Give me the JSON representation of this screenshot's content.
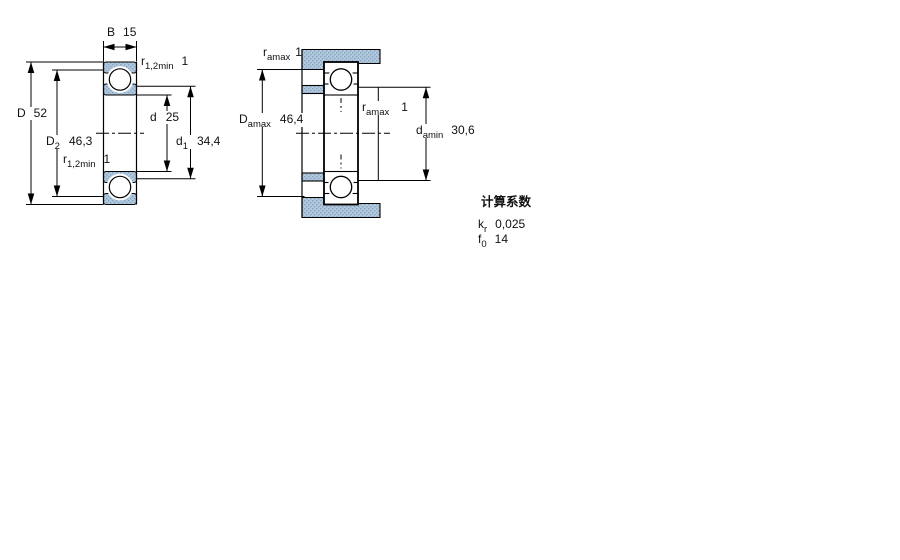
{
  "figure": {
    "type": "bearing-dimension-drawing",
    "background": "#ffffff",
    "line_color": "#000000",
    "hatch_base_color": "#b0c7dc",
    "hatch_dot_color": "#86a5c2"
  },
  "left_diagram": {
    "description": "bearing cross section with boundary dimensions",
    "labels": {
      "B": {
        "base": "B",
        "sub": "",
        "value": "15"
      },
      "D": {
        "base": "D",
        "sub": "",
        "value": "52"
      },
      "D2": {
        "base": "D",
        "sub": "2",
        "value": "46,3"
      },
      "r12_top": {
        "base": "r",
        "sub": "1,2min",
        "value": "1"
      },
      "r12_bottom": {
        "base": "r",
        "sub": "1,2min",
        "value": "1"
      },
      "d": {
        "base": "d",
        "sub": "",
        "value": "25"
      },
      "d1": {
        "base": "d",
        "sub": "1",
        "value": "34,4"
      }
    }
  },
  "right_diagram": {
    "description": "mounted bearing with abutment dimensions",
    "labels": {
      "ra_top": {
        "base": "r",
        "sub": "amax",
        "value": "1"
      },
      "Da": {
        "base": "D",
        "sub": "amax",
        "value": "46,4"
      },
      "ra_mid": {
        "base": "r",
        "sub": "amax",
        "value": "1"
      },
      "da": {
        "base": "d",
        "sub": "amin",
        "value": "30,6"
      }
    }
  },
  "calculation_factors": {
    "title": "计算系数",
    "rows": [
      {
        "base": "k",
        "sub": "r",
        "value": "0,025"
      },
      {
        "base": "f",
        "sub": "0",
        "value": "14"
      }
    ]
  }
}
